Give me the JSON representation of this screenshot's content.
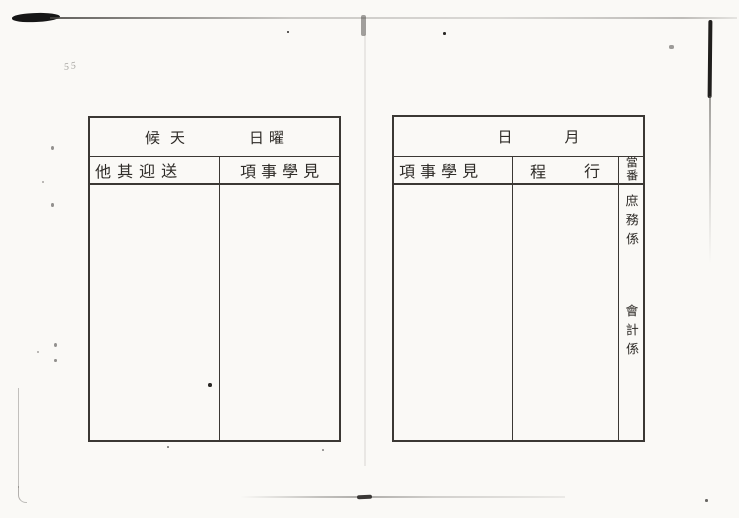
{
  "document": {
    "kind": "scanned blank handwritten ledger form",
    "pencil_note": "55",
    "paper_color": "#faf9f6",
    "background_color": "#f5f4f1",
    "ink_color": "#2e2b27",
    "line_color": "#3b3834"
  },
  "left_table": {
    "title_weather": "候天",
    "title_weekday": "日曜",
    "columns": [
      {
        "label": "他其迎送"
      },
      {
        "label": "項事學見"
      }
    ]
  },
  "right_table": {
    "title_date_month": "日",
    "title_date_day": "月",
    "columns": [
      {
        "label": "項事學見"
      },
      {
        "label": "程行"
      },
      {
        "label": "當番"
      }
    ],
    "duty_sections": [
      {
        "label": "庶務係"
      },
      {
        "label": "會計係"
      }
    ]
  }
}
